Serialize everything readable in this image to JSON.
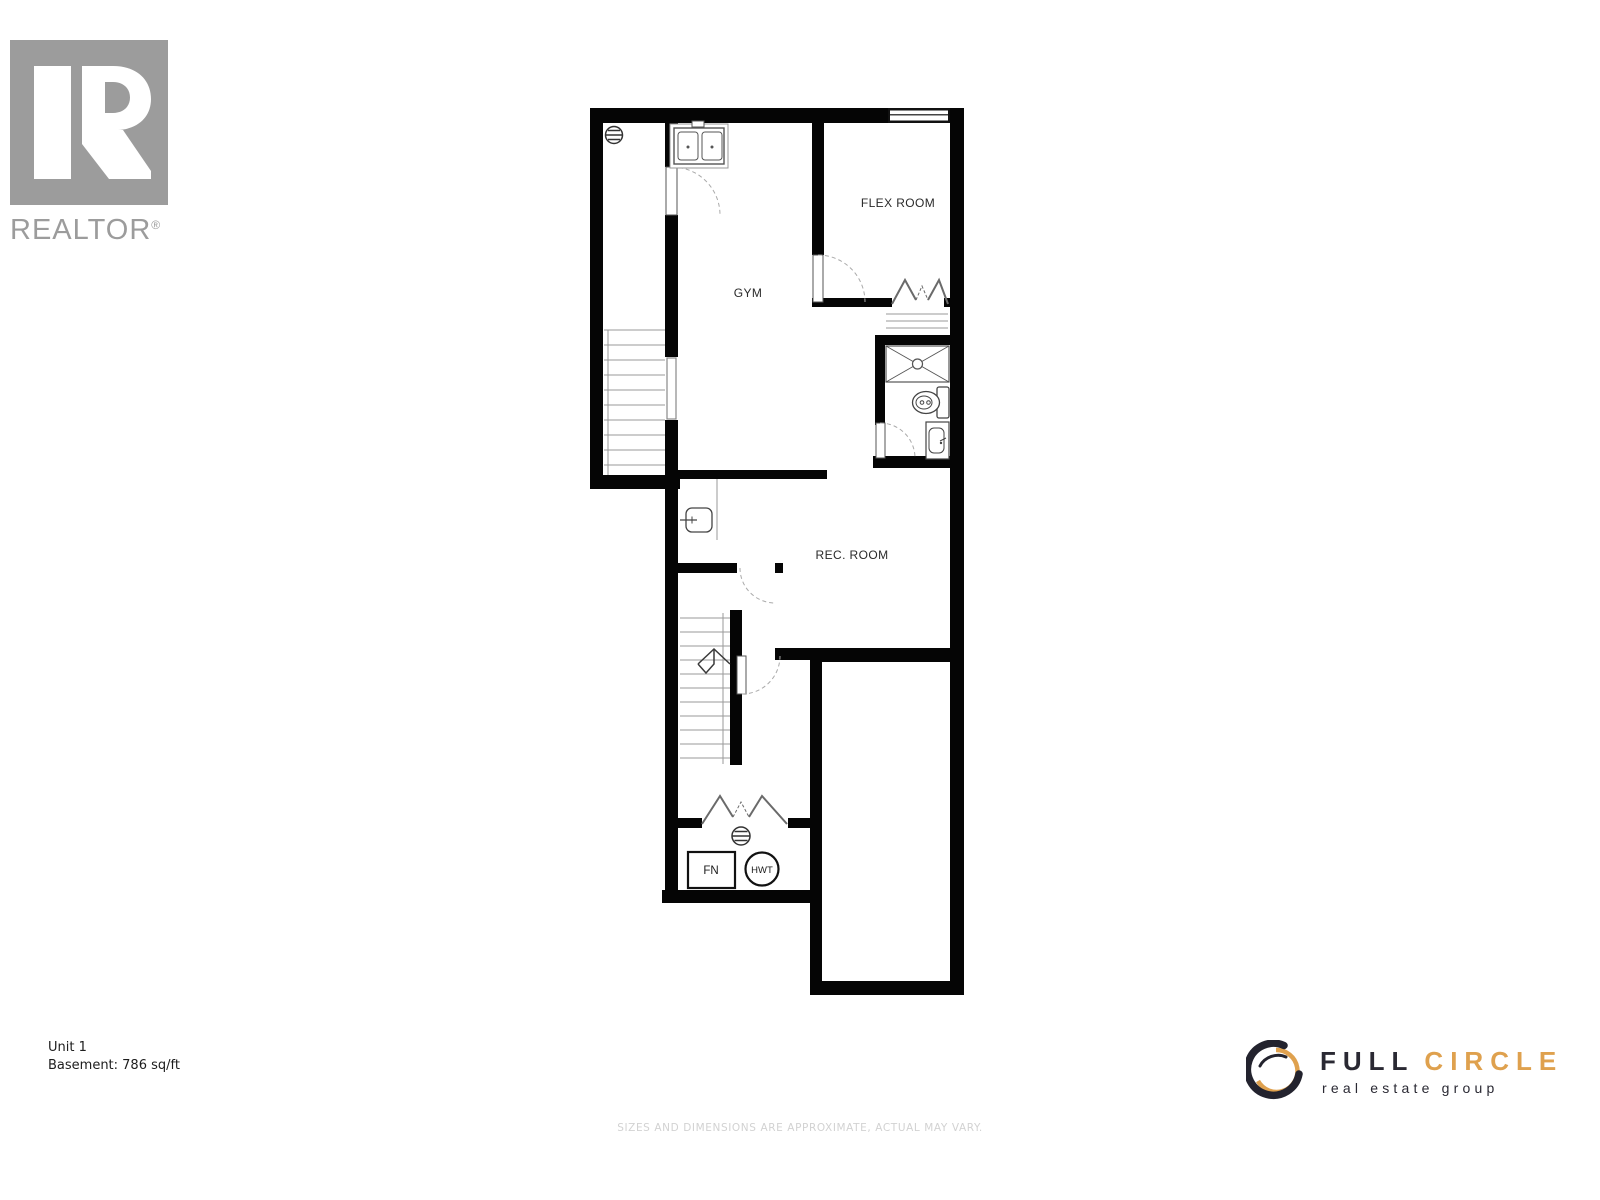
{
  "branding": {
    "realtor": {
      "logo_text": "REALTOR",
      "registered_mark": "®",
      "color": "#9C9C9C"
    },
    "full_circle": {
      "word1": "FULL",
      "word2": "CIRCLE",
      "tagline": "real estate group",
      "accent_color": "#DFA14E",
      "dark_color": "#2A2933"
    }
  },
  "floorplan": {
    "wall_color": "#000000",
    "rooms": [
      {
        "id": "gym",
        "label": "GYM"
      },
      {
        "id": "flex-room",
        "label": "FLEX ROOM"
      },
      {
        "id": "rec-room",
        "label": "REC. ROOM"
      }
    ],
    "equipment": [
      {
        "id": "furnace",
        "label": "FN"
      },
      {
        "id": "hot-water-tank",
        "label": "HWT"
      }
    ],
    "fixtures": [
      "window",
      "double-sink",
      "floor-drain",
      "stairs",
      "bifold-closet",
      "closet-shelves",
      "shower",
      "toilet",
      "vanity-sink",
      "bar-sink",
      "stairs-up-arrow",
      "floor-drain",
      "furnace-box",
      "hot-water-tank-circle"
    ]
  },
  "footer": {
    "unit_label": "Unit 1",
    "area_label": "Basement: 786 sq/ft",
    "disclaimer": "SIZES AND DIMENSIONS ARE APPROXIMATE, ACTUAL MAY VARY."
  }
}
